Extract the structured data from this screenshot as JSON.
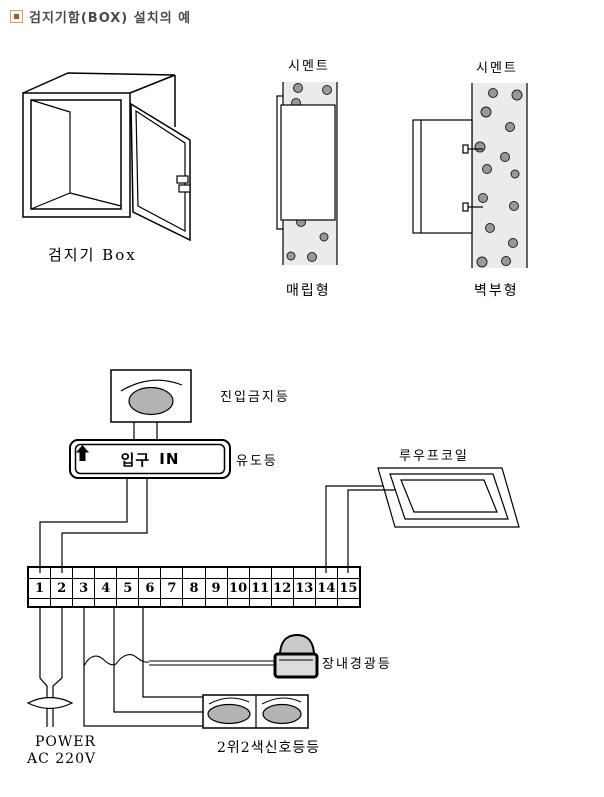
{
  "header": {
    "bullet_icon": "square-bullet-icon",
    "title": "검지기함(BOX) 설치의 예"
  },
  "detector_box": {
    "caption": "검지기 Box"
  },
  "embedded_type": {
    "material_label": "시멘트",
    "caption": "매립형"
  },
  "wall_mount_type": {
    "material_label": "시멘트",
    "caption": "벽부형"
  },
  "wiring": {
    "entry_no_light": {
      "label": "진입금지등"
    },
    "guide_sign": {
      "text_left": "입구",
      "arrow_icon": "up-arrow-icon",
      "text_right": "IN",
      "label": "유도등"
    },
    "loop_coil": {
      "label": "루우프코일"
    },
    "terminal_block": {
      "cells": [
        "1",
        "2",
        "3",
        "4",
        "5",
        "6",
        "7",
        "8",
        "9",
        "10",
        "11",
        "12",
        "13",
        "14",
        "15"
      ]
    },
    "warning_light": {
      "label": "장내경광등"
    },
    "signal_lights": {
      "label": "2위2색신호등등"
    },
    "power": {
      "line1": "POWER",
      "line2": "AC 220V"
    }
  },
  "colors": {
    "line": "#000000",
    "title_text": "#4a4a4a",
    "bullet_border": "#dd9966",
    "bullet_core": "#aa5522",
    "cement_fill": "#ebebeb",
    "aggregate_fill": "#999999",
    "lamp_fill": "#b3b3b3",
    "beacon_dome_fill": "#cacaca",
    "beacon_base_fill": "#dddddd"
  }
}
